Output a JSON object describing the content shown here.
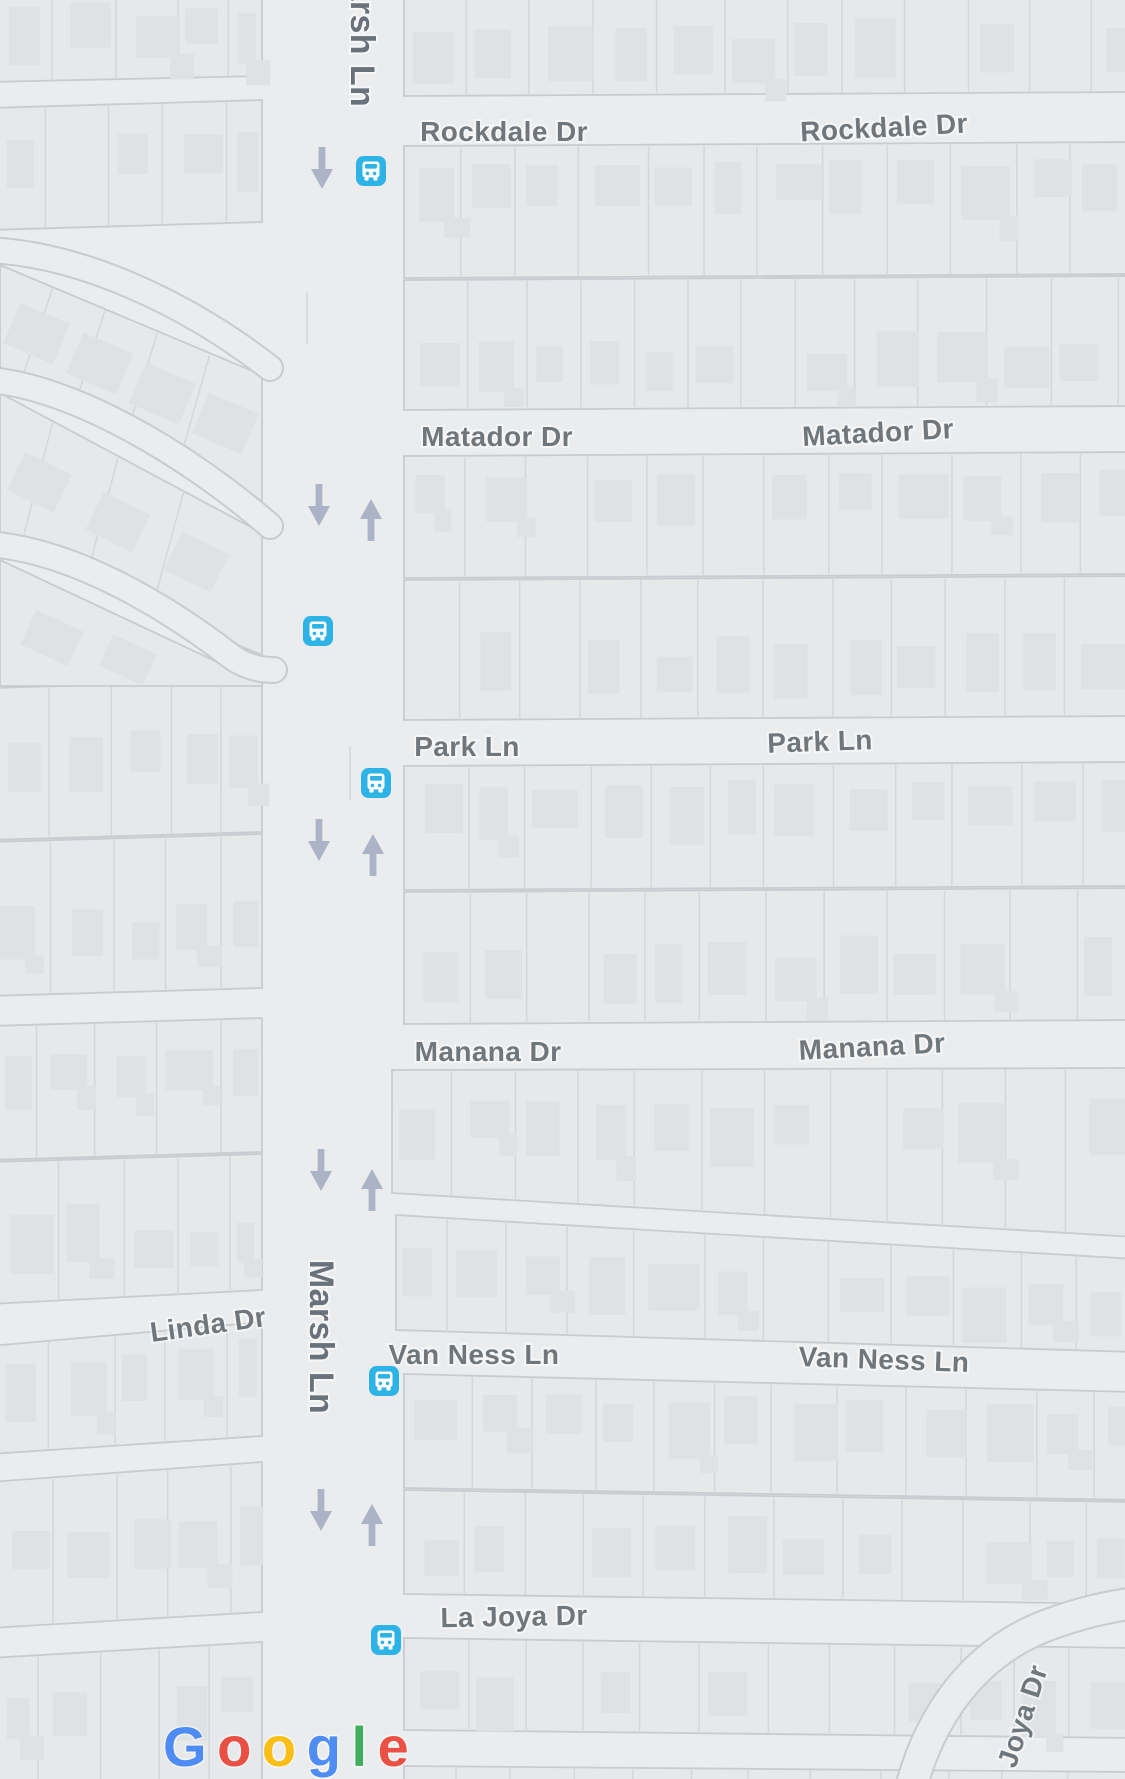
{
  "map": {
    "street_labels": {
      "marsh_top": "Marsh Ln",
      "rockdale_left": "Rockdale Dr",
      "rockdale_right": "Rockdale Dr",
      "matador_left": "Matador Dr",
      "matador_right": "Matador Dr",
      "park_left": "Park Ln",
      "park_right": "Park Ln",
      "manana_left": "Manana Dr",
      "manana_right": "Manana Dr",
      "linda": "Linda Dr",
      "van_ness_left": "Van Ness Ln",
      "van_ness_right": "Van Ness Ln",
      "marsh_main": "Marsh Ln",
      "la_joya": "La Joya Dr",
      "joya": "Joya Dr"
    },
    "transit": {
      "bus_stops": [
        {
          "x": 371,
          "y": 171
        },
        {
          "x": 318,
          "y": 631
        },
        {
          "x": 376,
          "y": 783
        },
        {
          "x": 384,
          "y": 1381
        },
        {
          "x": 386,
          "y": 1640
        }
      ],
      "direction_arrows": [
        {
          "x": 322,
          "y": 168,
          "dir": "down"
        },
        {
          "x": 319,
          "y": 505,
          "dir": "down"
        },
        {
          "x": 371,
          "y": 520,
          "dir": "up"
        },
        {
          "x": 319,
          "y": 840,
          "dir": "down"
        },
        {
          "x": 373,
          "y": 855,
          "dir": "up"
        },
        {
          "x": 321,
          "y": 1170,
          "dir": "down"
        },
        {
          "x": 372,
          "y": 1190,
          "dir": "up"
        },
        {
          "x": 321,
          "y": 1510,
          "dir": "down"
        },
        {
          "x": 372,
          "y": 1525,
          "dir": "up"
        }
      ]
    },
    "colors": {
      "bus_stop_blue": "#2eb3e7",
      "arrow_gray_blue": "#a9b0c4",
      "street_label_gray": "#6f777d"
    }
  },
  "attribution": {
    "brand": "Google",
    "letters": [
      {
        "ch": "G",
        "color": "#4285F4"
      },
      {
        "ch": "o",
        "color": "#EA4335"
      },
      {
        "ch": "o",
        "color": "#FBBC05"
      },
      {
        "ch": "g",
        "color": "#4285F4"
      },
      {
        "ch": "l",
        "color": "#34A853"
      },
      {
        "ch": "e",
        "color": "#EA4335"
      }
    ]
  }
}
